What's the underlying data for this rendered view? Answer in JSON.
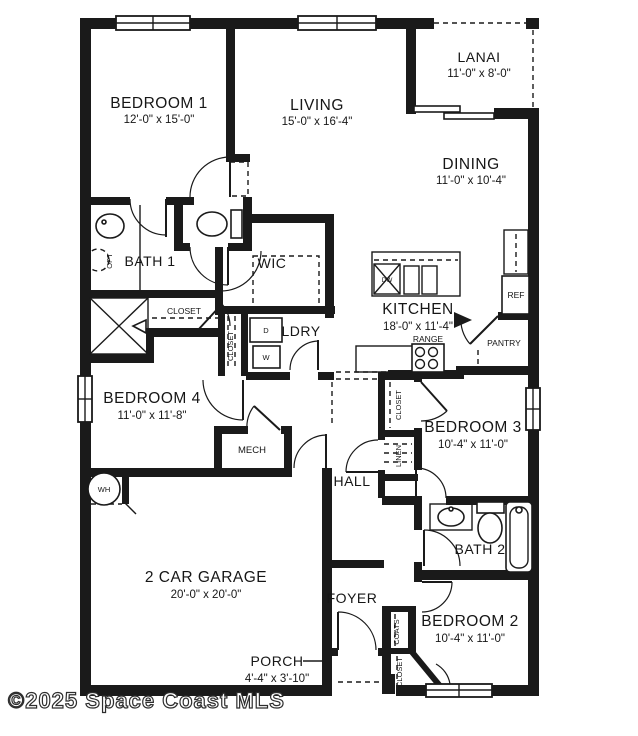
{
  "watermark": "©2025 Space Coast MLS",
  "colors": {
    "wall": "#1a1a1a",
    "background": "#ffffff"
  },
  "rooms": {
    "bedroom1": {
      "name": "BEDROOM 1",
      "dims": "12'-0\" x 15'-0\""
    },
    "living": {
      "name": "LIVING",
      "dims": "15'-0\" x 16'-4\""
    },
    "lanai": {
      "name": "LANAI",
      "dims": "11'-0\" x 8'-0\""
    },
    "dining": {
      "name": "DINING",
      "dims": "11'-0\" x 10'-4\""
    },
    "kitchen": {
      "name": "KITCHEN",
      "dims": "18'-0\" x 11'-4\""
    },
    "bath1": {
      "name": "BATH 1"
    },
    "wic": {
      "name": "WIC"
    },
    "ldry": {
      "name": "LDRY"
    },
    "bedroom4": {
      "name": "BEDROOM 4",
      "dims": "11'-0\" x 11'-8\""
    },
    "bedroom3": {
      "name": "BEDROOM 3",
      "dims": "10'-4\" x 11'-0\""
    },
    "bedroom2": {
      "name": "BEDROOM 2",
      "dims": "10'-4\" x 11'-0\""
    },
    "bath2": {
      "name": "BATH 2"
    },
    "hall": {
      "name": "HALL"
    },
    "foyer": {
      "name": "FOYER"
    },
    "garage": {
      "name": "2 CAR GARAGE",
      "dims": "20'-0\" x 20'-0\""
    },
    "porch": {
      "name": "PORCH",
      "dims": "4'-4\" x 3'-10\""
    },
    "mech": {
      "name": "MECH"
    },
    "pantry": {
      "name": "PANTRY"
    }
  },
  "fixtures": {
    "closet_bath1": "CLOSET",
    "closet_bed4": "CLOSET",
    "closet_bed3": "CLOSET",
    "linen": "LINEN",
    "coats": "COATS",
    "closet_bed2": "CLOSET",
    "dryer": "D",
    "washer": "W",
    "dishwasher": "DW",
    "range": "RANGE",
    "ref": "REF",
    "water_heater": "WH",
    "optional": "OPT"
  }
}
